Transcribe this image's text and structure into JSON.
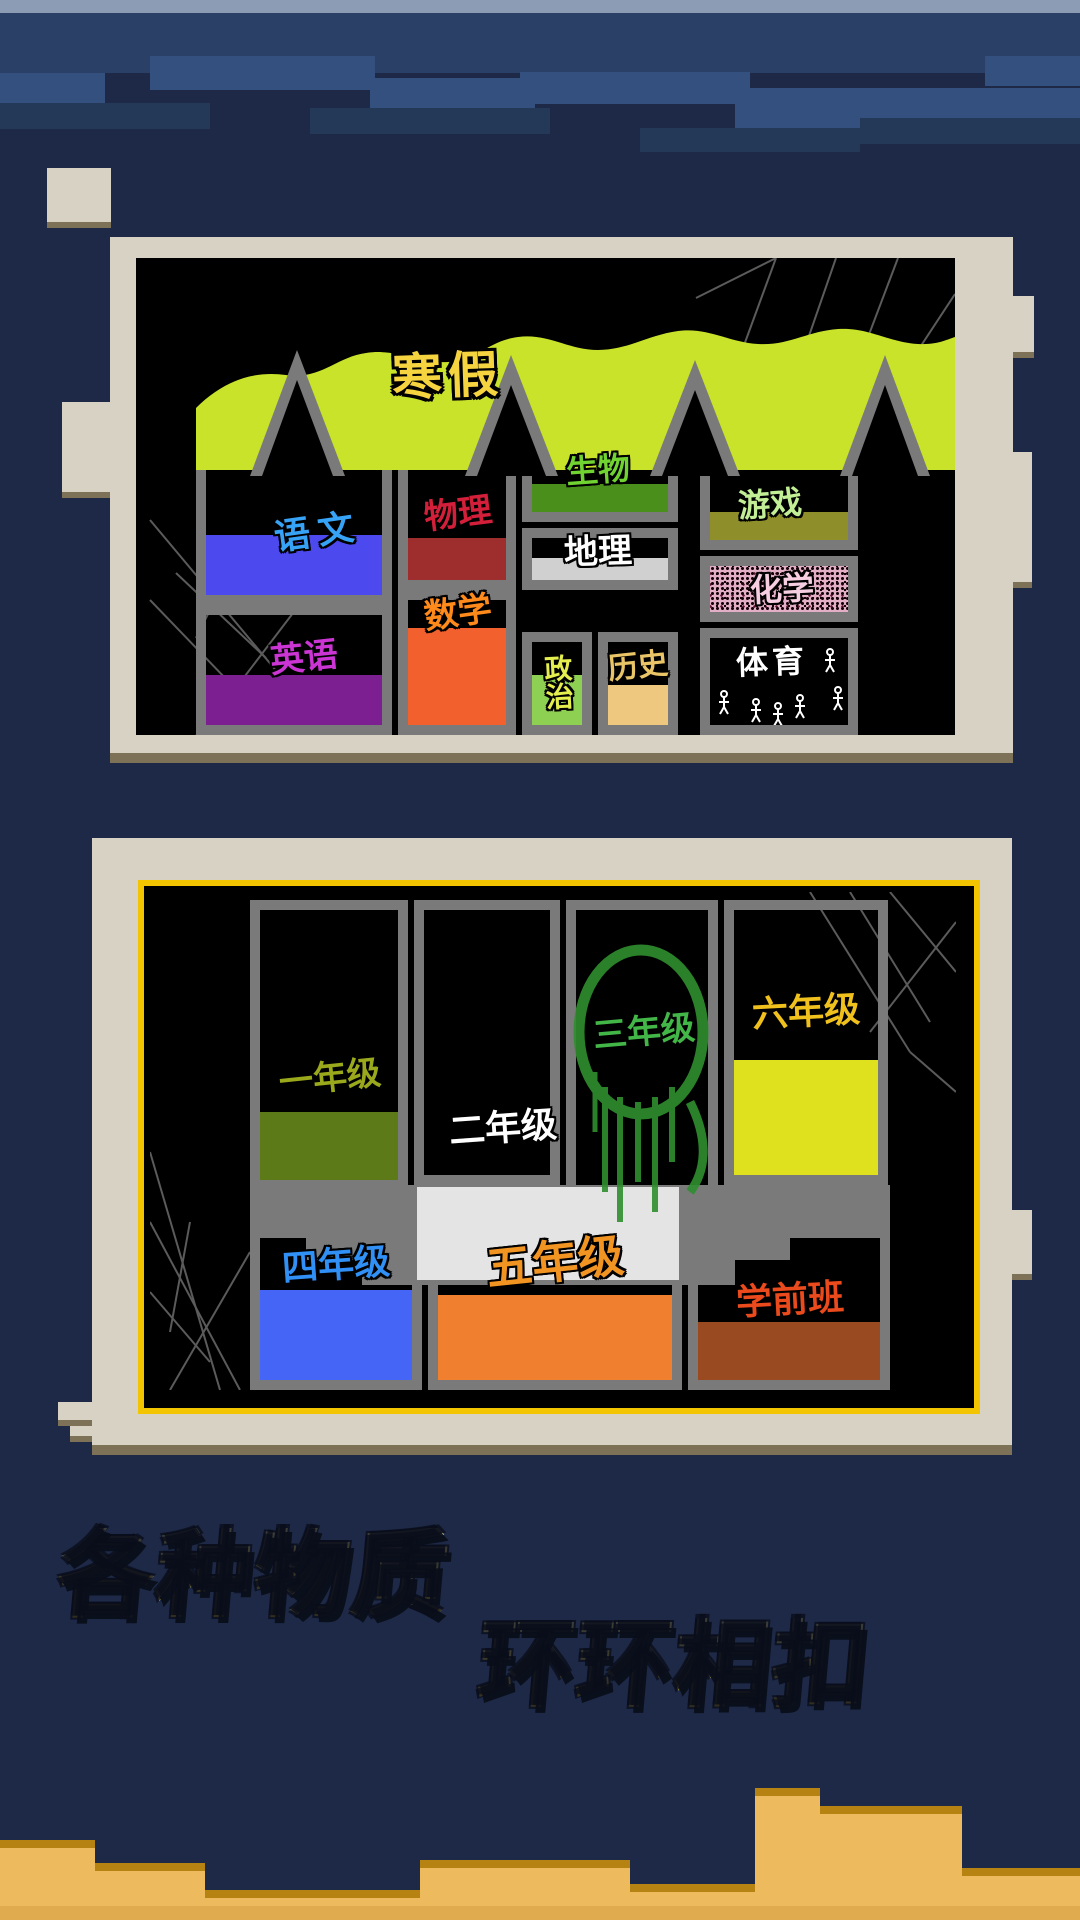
{
  "background": {
    "sky_top_strip": "#8d9cb5",
    "sky_band": "#2b4066",
    "sky_base": "#1d2946",
    "sand": "#eeba5e",
    "sand_edge": "#b68312"
  },
  "panel1": {
    "title": "寒假",
    "title_color": "#f6d440",
    "terrain_color": "#c9e22a",
    "divider_color": "#7a7a7a",
    "subjects": [
      {
        "label": "语文",
        "text_color": "#37a3f7",
        "block_color": "#4c49ef"
      },
      {
        "label": "物理",
        "text_color": "#d41f3a",
        "block_color": "#9e2e2e"
      },
      {
        "label": "生物",
        "text_color": "#71d331",
        "block_color": "#4a8f1b"
      },
      {
        "label": "地理",
        "text_color": "#ffffff",
        "block_color": "#d0d0d0"
      },
      {
        "label": "游戏",
        "text_color": "#c2ee96",
        "block_color": "#8e8e2b"
      },
      {
        "label": "化学",
        "text_color": "#f6cde1",
        "block_color": "#e3afc6"
      },
      {
        "label": "英语",
        "text_color": "#cb35d4",
        "block_color": "#7c2091"
      },
      {
        "label": "数学",
        "text_color": "#fe8a1b",
        "block_color": "#f2602e"
      },
      {
        "label": "政治",
        "text_color": "#e4ee4e",
        "block_color": "#8ed051"
      },
      {
        "label": "历史",
        "text_color": "#eac567",
        "block_color": "#eec87f"
      },
      {
        "label": "体育",
        "text_color": "#ffffff",
        "block_color": "#000000"
      }
    ]
  },
  "panel2": {
    "border_color": "#f2c500",
    "divider_color": "#7a7a7a",
    "grades": [
      {
        "label": "一年级",
        "text_color": "#9aa81c",
        "block_color": "#5d7a18"
      },
      {
        "label": "二年级",
        "text_color": "#ffffff",
        "block_color": "#e4e4e4"
      },
      {
        "label": "三年级",
        "text_color": "#43b648",
        "block_color": "#2f8f2f"
      },
      {
        "label": "六年级",
        "text_color": "#f0c11c",
        "block_color": "#dfe11f"
      },
      {
        "label": "四年级",
        "text_color": "#3090f5",
        "block_color": "#4465f5"
      },
      {
        "label": "五年级",
        "text_color": "#f29422",
        "block_color": "#f08030"
      },
      {
        "label": "学前班",
        "text_color": "#ea4a1c",
        "block_color": "#9a4a20"
      }
    ]
  },
  "tagline": {
    "line1": "各种物质",
    "line2": "环环相扣",
    "color_top": "#fdf6b0",
    "color_bottom": "#c9a529"
  }
}
